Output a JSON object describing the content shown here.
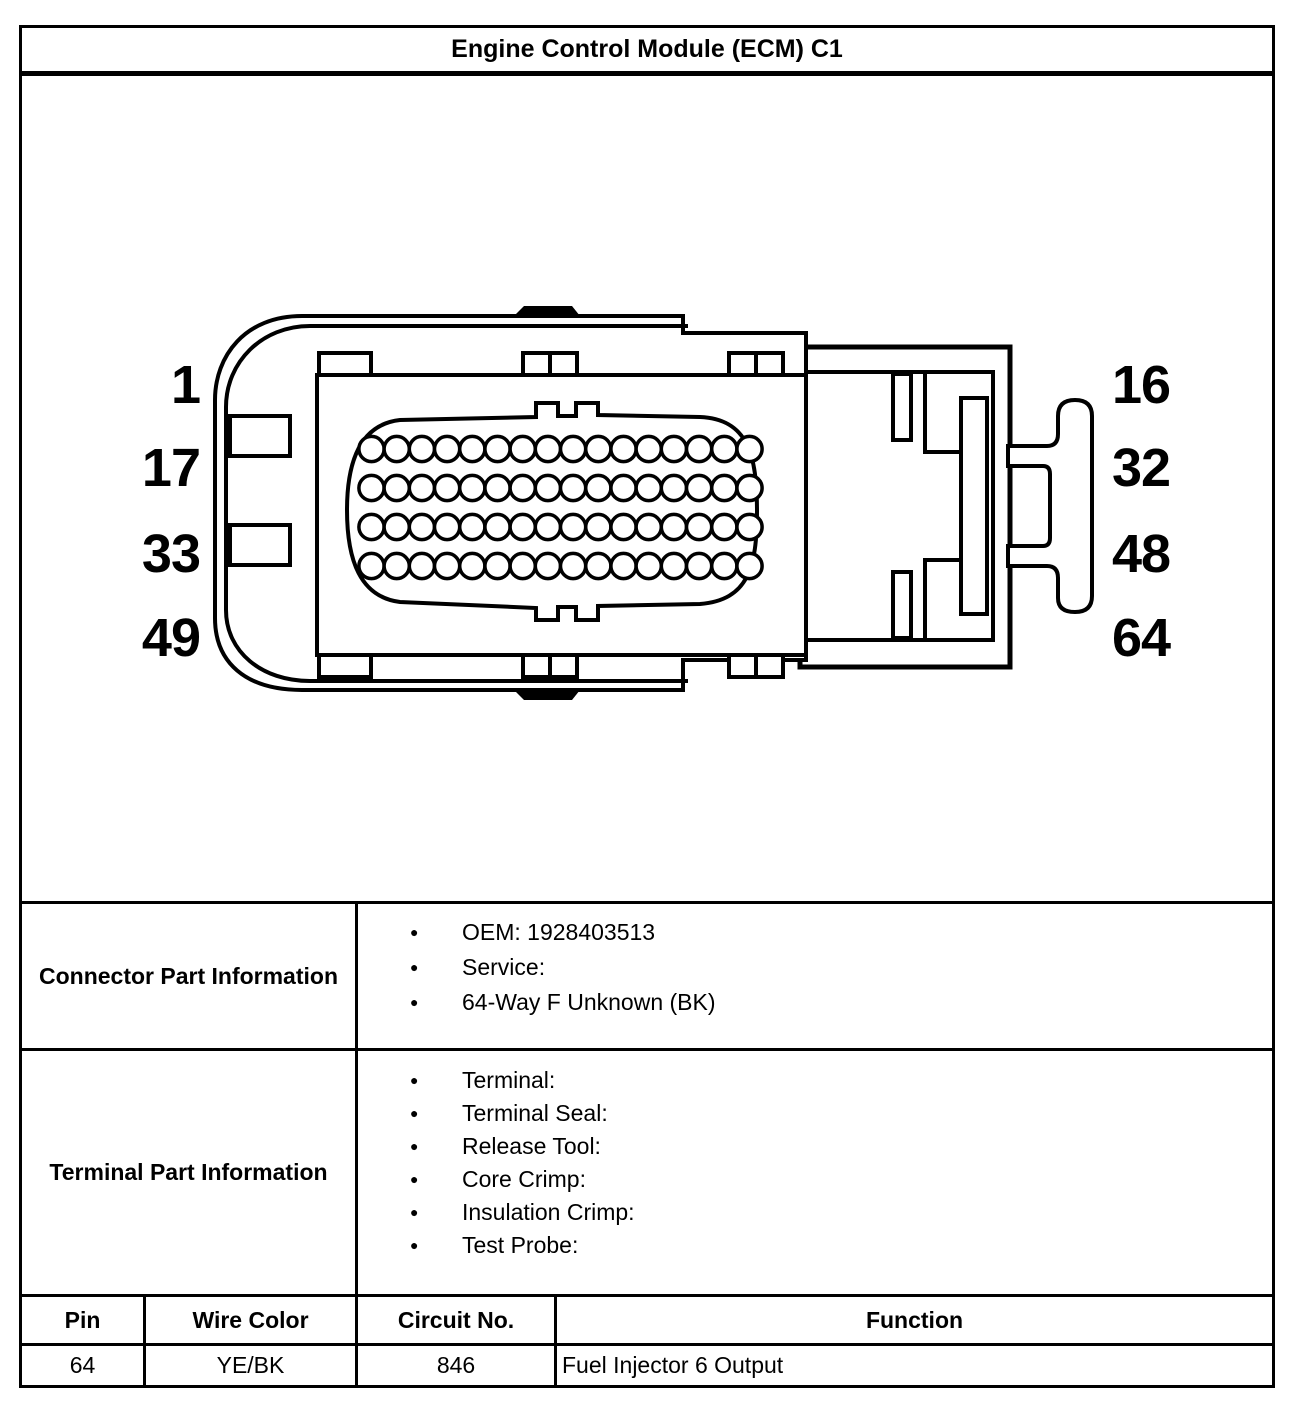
{
  "title": "Engine Control Module (ECM) C1",
  "diagram": {
    "pin_labels_left": [
      "1",
      "17",
      "33",
      "49"
    ],
    "pin_labels_right": [
      "16",
      "32",
      "48",
      "64"
    ],
    "rows": 4,
    "cols": 16,
    "colors": {
      "line": "#000000",
      "fill": "#ffffff"
    }
  },
  "connector_part_information": {
    "label": "Connector Part Information",
    "items": [
      "OEM: 1928403513",
      "Service:",
      "64-Way F Unknown (BK)"
    ]
  },
  "terminal_part_information": {
    "label": "Terminal Part Information",
    "items": [
      "Terminal:",
      "Terminal Seal:",
      "Release Tool:",
      "Core Crimp:",
      "Insulation Crimp:",
      "Test Probe:"
    ]
  },
  "pin_table": {
    "headers": [
      "Pin",
      "Wire Color",
      "Circuit No.",
      "Function"
    ],
    "rows": [
      [
        "64",
        "YE/BK",
        "846",
        "Fuel Injector 6 Output"
      ]
    ]
  }
}
